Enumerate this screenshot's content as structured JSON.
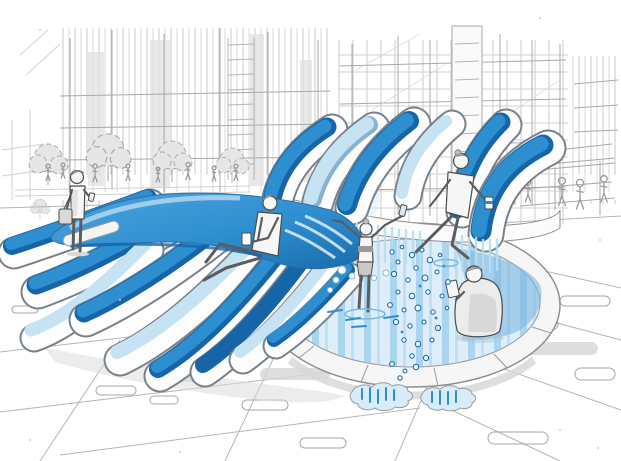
{
  "title": "Urban plaza water-sculpture concept sketch",
  "colors": {
    "paper": "#ffffff",
    "ink": "#4c4c4c",
    "mid_gray": "#b5b5b5",
    "light_gray": "#dedede",
    "shadow_gray": "#cccccc",
    "primary_blue": "#2e8fd0",
    "deep_blue": "#1565a8",
    "sky_blue": "#7fc0e8",
    "pale_blue": "#c6e3f4",
    "water_base": "#ddeefa",
    "water_stripe": "#8ec6e8"
  },
  "scene": {
    "subject": "Hand-drawn concept sketch of a curved blue ribbon water sculpture with a circular splash pool in a city plaza",
    "style": "marker sketch, gray linework with blue accents",
    "background": "sketched high-rise towers with curtain-wall grids, plaza trees and pedestrians",
    "sculpture": "fan of curved blue-and-white ribbon slides arcing into the pool",
    "pool": "circular splash pool with striped blue water, droplets and puddles",
    "figures": [
      "pedestrian standing with shoulder bag and phone",
      "man sitting on the ribbon crest holding a drink",
      "child splashing in the pool with arms raised",
      "woman sitting on the back ledge with feet toward the water",
      "man sitting in the pool reading a phone"
    ],
    "details": [
      "water droplets spray",
      "puddles with blue reflections",
      "paving joint lines and pill-shaped pavers",
      "falling water curtain under the ledge"
    ]
  }
}
